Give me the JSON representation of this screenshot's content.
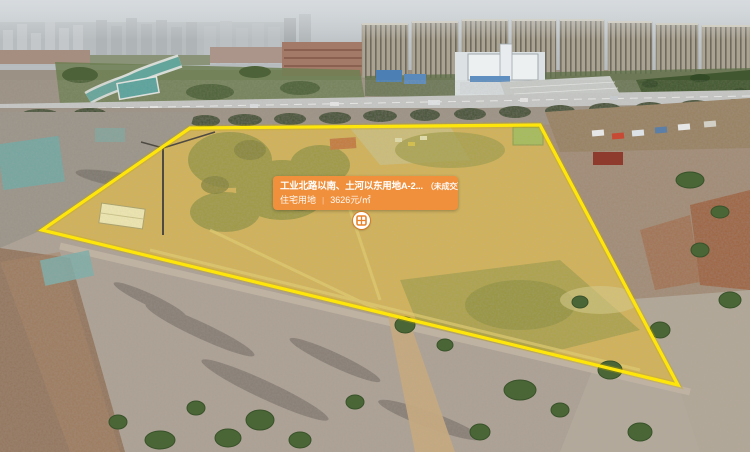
{
  "colors": {
    "accent_orange": "#F0903C",
    "boundary_yellow": "#FFE60A",
    "parcel_tint": "#F2E23C"
  },
  "parcel_card": {
    "title": "工业北路以南、土河以东用地A-2...",
    "status": "（未成交）",
    "land_use": "住宅用地",
    "separator": "|",
    "unit_price": "3626元/㎡"
  },
  "marker": {
    "icon": "parcel-grid-icon"
  }
}
